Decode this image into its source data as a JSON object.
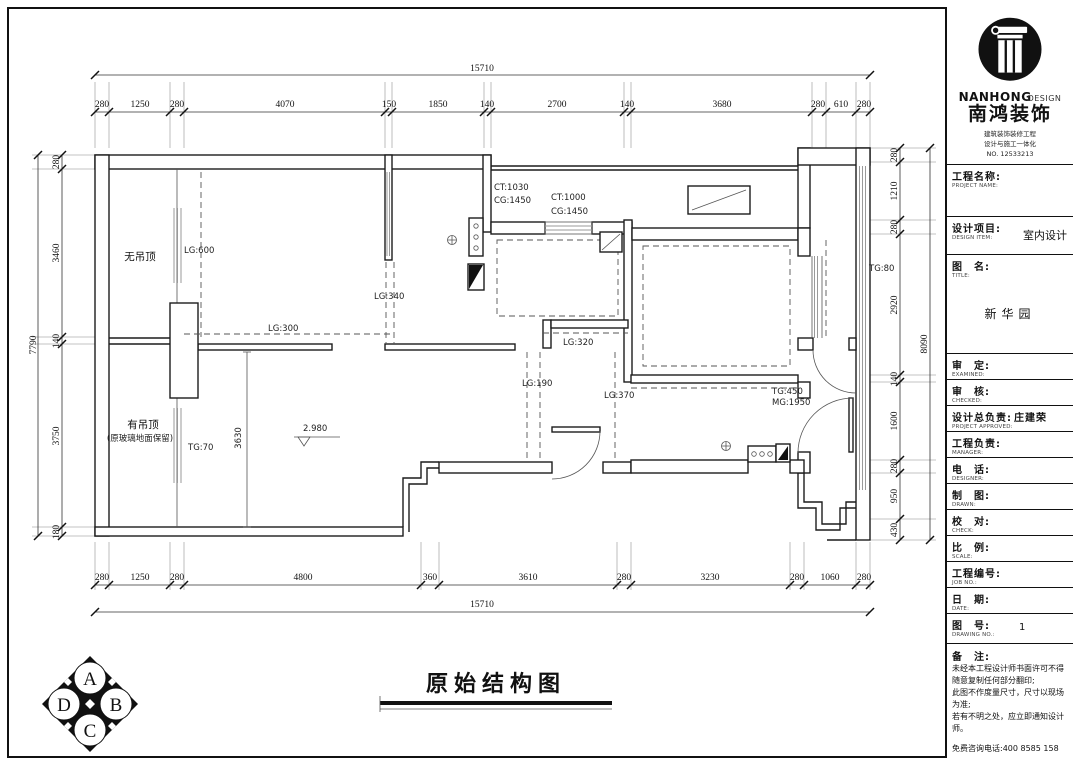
{
  "drawing": {
    "title": "原始结构图",
    "dims": {
      "top": {
        "total": "15710",
        "segments": [
          "280",
          "1250",
          "280",
          "4070",
          "150",
          "1850",
          "140",
          "2700",
          "140",
          "3680",
          "280",
          "610",
          "280"
        ]
      },
      "bottom": {
        "total": "15710",
        "segments": [
          "280",
          "1250",
          "280",
          "4800",
          "360",
          "3610",
          "280",
          "3230",
          "280",
          "1060",
          "280"
        ]
      },
      "left": {
        "total": "7790",
        "segments": [
          "280",
          "3460",
          "140",
          "3750",
          "180"
        ]
      },
      "right": {
        "total": "8090",
        "segments": [
          "280",
          "1210",
          "280",
          "2920",
          "140",
          "1600",
          "280",
          "950",
          "430"
        ]
      }
    },
    "labels": {
      "no_ceiling": "无吊顶",
      "has_ceiling": "有吊顶",
      "has_ceiling_note": "(原玻璃地面保留)",
      "lg600": "LG:600",
      "lg340": "LG:340",
      "lg300": "LG:300",
      "lg320": "LG:320",
      "lg190": "LG:190",
      "lg370": "LG:370",
      "ct1030": "CT:1030",
      "cg1450a": "CG:1450",
      "ct1000": "CT:1000",
      "cg1450b": "CG:1450",
      "tg80": "TG:80",
      "tg450": "TG:450",
      "mg1950": "MG:1950",
      "tg70": "TG:70",
      "room_dim_3630": "3630",
      "level": "2.980"
    },
    "badge_letters": {
      "a": "A",
      "b": "B",
      "c": "C",
      "d": "D"
    }
  },
  "title_block": {
    "company": {
      "name_en_bold": "NANHONG",
      "name_en_light": "DESIGN",
      "name_cn": "南鸿装饰",
      "cred1": "建筑装饰装修工程",
      "cred2": "设计与施工一体化",
      "cred3": "NO. 12533213"
    },
    "fields": [
      {
        "label": "工程名称:",
        "sub": "PROJECT NAME:",
        "value": ""
      },
      {
        "label": "设计项目:",
        "sub": "DESIGN ITEM:",
        "value": "室内设计"
      },
      {
        "label": "图　名:",
        "sub": "TITLE:",
        "value": "新华园"
      },
      {
        "label": "审　定:",
        "sub": "EXAMINED:",
        "value": ""
      },
      {
        "label": "审　核:",
        "sub": "CHECKED:",
        "value": ""
      },
      {
        "label": "设计总负责:",
        "sub": "PROJECT APPROVED:",
        "value": "庄建荣"
      },
      {
        "label": "工程负责:",
        "sub": "MANAGER:",
        "value": ""
      },
      {
        "label": "电　话:",
        "sub": "DESIGNER:",
        "value": ""
      },
      {
        "label": "制　图:",
        "sub": "DRAWN:",
        "value": ""
      },
      {
        "label": "校　对:",
        "sub": "CHECK:",
        "value": ""
      },
      {
        "label": "比　例:",
        "sub": "SCALE:",
        "value": ""
      },
      {
        "label": "工程编号:",
        "sub": "JOB NO.:",
        "value": ""
      },
      {
        "label": "日　期:",
        "sub": "DATE:",
        "value": ""
      },
      {
        "label": "图　号:",
        "sub": "DRAWING NO.:",
        "value": "1"
      }
    ],
    "notes": {
      "label": "备　注:",
      "lines": [
        "未经本工程设计师书面许可不得随意复制任何部分翻印;",
        "此图不作度量尺寸，尺寸以现场为准;",
        "若有不明之处，应立即通知设计师。"
      ],
      "hotline": "免费咨询电话:400 8585 158"
    }
  }
}
